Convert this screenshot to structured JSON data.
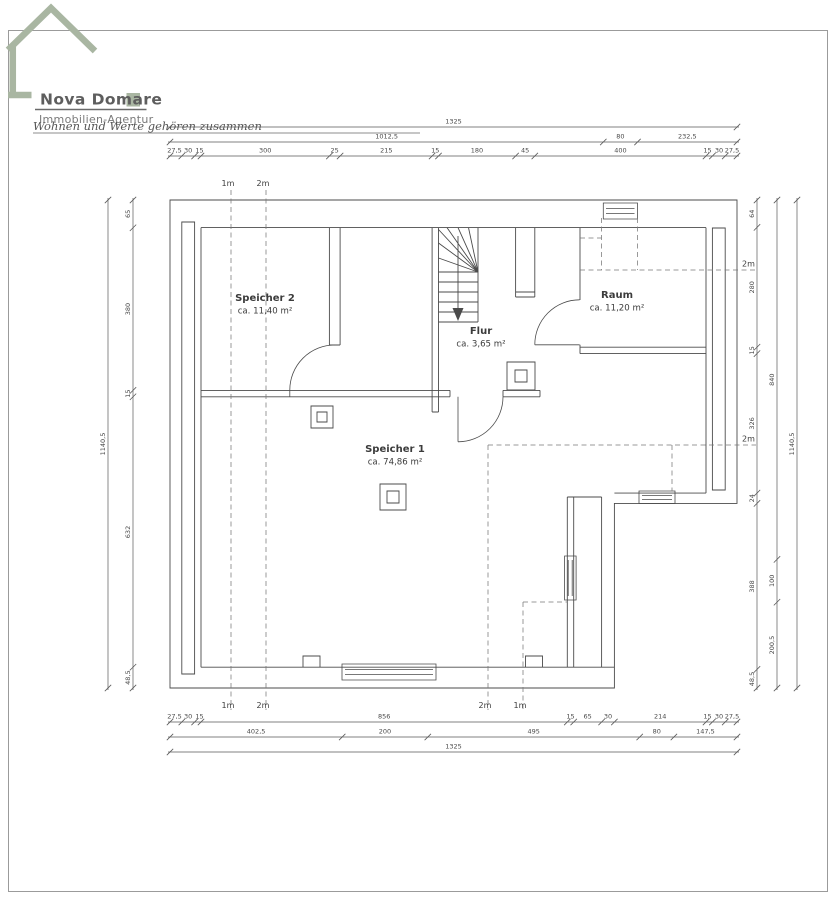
{
  "logo": {
    "name": "Nova Domare",
    "subtitle": "Immobilien-Agentur",
    "slogan": "Wohnen und Werte gehören zusammen",
    "accent_color": "#a9b6a2"
  },
  "rooms": {
    "speicher2": {
      "name": "Speicher 2",
      "area": "ca. 11,40 m²"
    },
    "speicher1": {
      "name": "Speicher 1",
      "area": "ca. 74,86 m²"
    },
    "raum": {
      "name": "Raum",
      "area": "ca. 11,20 m²"
    },
    "flur": {
      "name": "Flur",
      "area": "ca. 3,65 m²"
    }
  },
  "hl": {
    "top": [
      "1m",
      "2m"
    ],
    "right": [
      "2m",
      "2m"
    ],
    "bottom": [
      "1m",
      "2m",
      "2m",
      "1m"
    ]
  },
  "dims": {
    "top": {
      "row1": [
        "1325"
      ],
      "row2": [
        "1012,5",
        "80",
        "232,5"
      ],
      "row3": [
        "27,5",
        "30",
        "15",
        "300",
        "25",
        "215",
        "15",
        "180",
        "45",
        "400",
        "15",
        "30",
        "27,5"
      ]
    },
    "bottom": {
      "row1": [
        "27,5",
        "30",
        "15",
        "856",
        "15",
        "65",
        "30",
        "214",
        "15",
        "30",
        "27,5"
      ],
      "row2": [
        "402,5",
        "200",
        "495",
        "80",
        "147,5"
      ],
      "row3": [
        "1325"
      ]
    },
    "left": {
      "inner": [
        "65",
        "380",
        "15",
        "632",
        "48,5"
      ],
      "outer": [
        "1140,5"
      ]
    },
    "right": {
      "inner": [
        "64",
        "280",
        "15",
        "326",
        "24",
        "388",
        "48,5"
      ],
      "middle": [
        "840",
        "100",
        "200,5"
      ],
      "outer": [
        "1140,5"
      ]
    }
  }
}
